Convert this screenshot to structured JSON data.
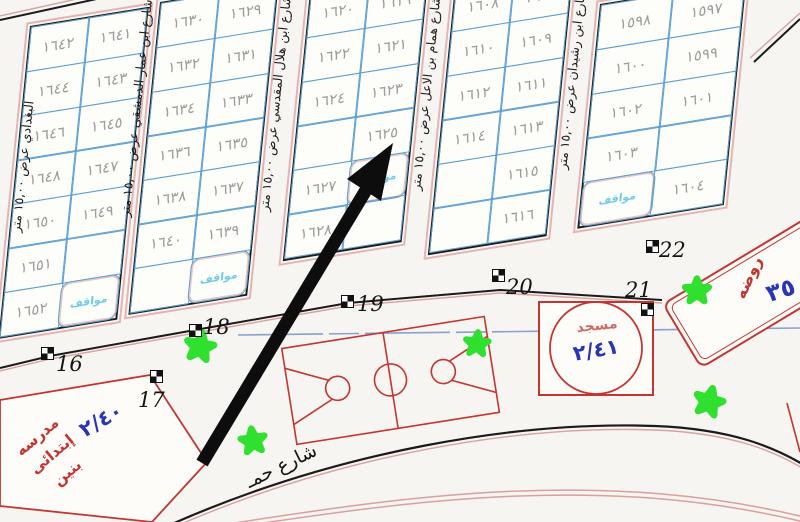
{
  "map": {
    "title": "land subdivision plan",
    "parking_label": "مواقف",
    "blocks": [
      {
        "id": "A",
        "rows": [
          {
            "left": "١٦٤٢",
            "right": "١٦٤١"
          },
          {
            "left": "١٦٤٤",
            "right": "١٦٤٣"
          },
          {
            "left": "١٦٤٦",
            "right": "١٦٤٥"
          },
          {
            "left": "١٦٤٨",
            "right": "١٦٤٧"
          },
          {
            "left": "١٦٥٠",
            "right": "١٦٤٩"
          },
          {
            "left": "١٦٥١",
            "right": ""
          },
          {
            "left": "١٦٥٢",
            "right": "مواقف"
          }
        ]
      },
      {
        "id": "B",
        "rows": [
          {
            "left": "١٦٣٠",
            "right": "١٦٢٩"
          },
          {
            "left": "١٦٣٢",
            "right": "١٦٣١"
          },
          {
            "left": "١٦٣٤",
            "right": "١٦٣٣"
          },
          {
            "left": "١٦٣٦",
            "right": "١٦٣٥"
          },
          {
            "left": "١٦٣٨",
            "right": "١٦٣٧"
          },
          {
            "left": "١٦٤٠",
            "right": "١٦٣٩"
          },
          {
            "left": "",
            "right": "مواقف"
          }
        ]
      },
      {
        "id": "C",
        "rows": [
          {
            "left": "١٦٢٠",
            "right": "١٦١٩"
          },
          {
            "left": "١٦٢٢",
            "right": "١٦٢١"
          },
          {
            "left": "١٦٢٤",
            "right": "١٦٢٣"
          },
          {
            "left": "",
            "right": "١٦٢٥"
          },
          {
            "left": "١٦٢٧",
            "right": "مواقف"
          },
          {
            "left": "١٦٢٨",
            "right": ""
          }
        ]
      },
      {
        "id": "D",
        "rows": [
          {
            "left": "١٦٠٨",
            "right": "١٦٠٧"
          },
          {
            "left": "١٦١٠",
            "right": "١٦٠٩"
          },
          {
            "left": "١٦١٢",
            "right": "١٦١١"
          },
          {
            "left": "١٦١٤",
            "right": "١٦١٣"
          },
          {
            "left": "",
            "right": "١٦١٥"
          },
          {
            "left": "",
            "right": "١٦١٦"
          }
        ]
      },
      {
        "id": "E",
        "rows": [
          {
            "left": "١٥٩٨",
            "right": "١٥٩٧"
          },
          {
            "left": "١٦٠٠",
            "right": "١٥٩٩"
          },
          {
            "left": "١٦٠٢",
            "right": "١٦٠١"
          },
          {
            "left": "١٦٠٣",
            "right": ""
          },
          {
            "left": "مواقف",
            "right": "١٦٠٤"
          }
        ]
      }
    ],
    "streets": [
      {
        "name": "البغدادي عرض ١٥,٠٠ متر"
      },
      {
        "name": "شارع ابن عمار الدمشقي عرض ١٥,٠٠ متر"
      },
      {
        "name": "شارع ابن هلال المقدسي عرض ١٥,٠٠ متر"
      },
      {
        "name": "شارع همام بن الاعل عرض ١٥,٠٠ متر"
      },
      {
        "name": "شارع ابن رشيدان عرض ١٥,٠٠ متر"
      }
    ],
    "junctions": [
      "16",
      "17",
      "18",
      "19",
      "20",
      "21",
      "22"
    ],
    "school": {
      "name_lines": [
        "مدرسه",
        "إبتدائى",
        "بنين"
      ],
      "number": "٢/٤٠"
    },
    "mosque": {
      "label": "مسجد",
      "number": "٢/٤١"
    },
    "kindergarten": {
      "label": "روضه",
      "number": "٣٥"
    },
    "bottom_street": {
      "name": "شارع حمـ"
    },
    "colors": {
      "plot_grid_blue": "#5a9fd4",
      "plot_number_gray": "#9c9c9c",
      "parking_cyan": "#6ecbe8",
      "annotation_red": "#c43530",
      "annotation_blue": "#2a35b5",
      "tree_green": "#2fe02f",
      "line_black": "#1b1b1b",
      "street_edge_pink": "#d9a0a0"
    }
  }
}
